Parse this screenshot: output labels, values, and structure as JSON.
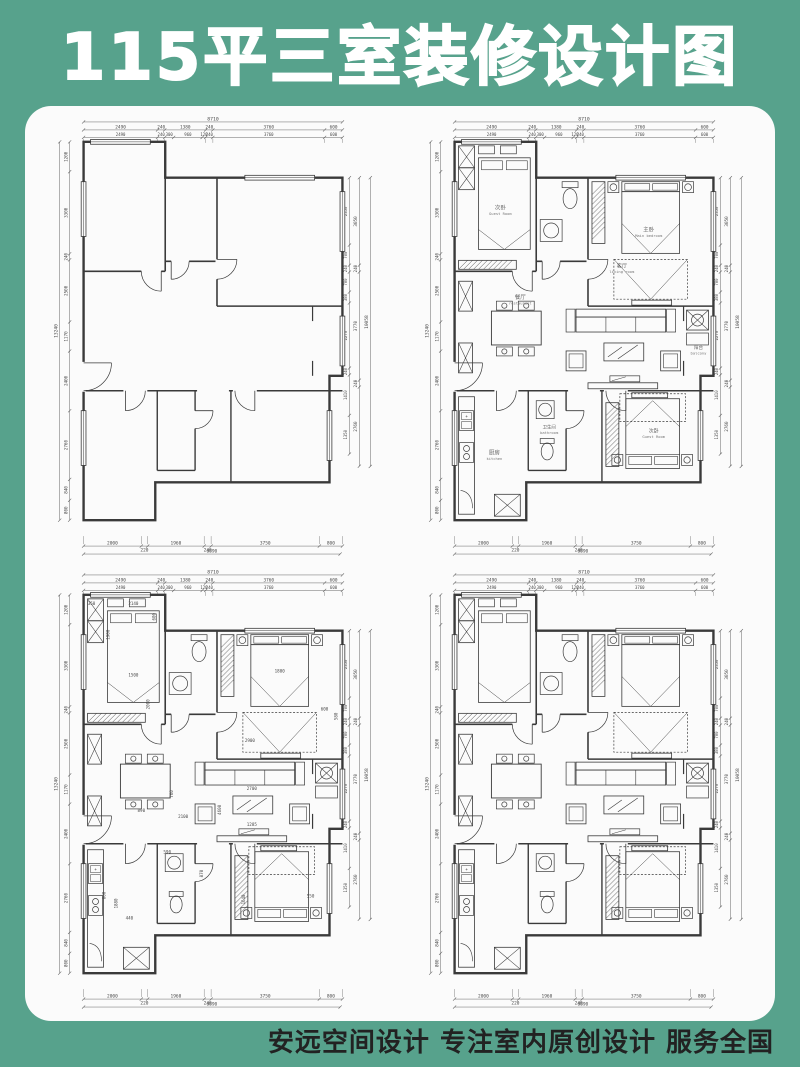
{
  "title": "115平三室装修设计图",
  "footer": "安远空间设计 专注室内原创设计 服务全国",
  "colors": {
    "background": "#57a28c",
    "panel": "#fbfbfb",
    "wall_line": "#3a3a3a",
    "dim_line": "#666666",
    "dim_text": "#4a4a4a"
  },
  "plans": [
    {
      "name": "original-structure-plan",
      "furnished": false,
      "labels": false,
      "interior_dims": false
    },
    {
      "name": "furnished-plan-labeled",
      "furnished": true,
      "labels": true,
      "interior_dims": false
    },
    {
      "name": "furnished-plan-dimensioned",
      "furnished": true,
      "labels": false,
      "interior_dims": true
    },
    {
      "name": "furnished-plan-plain",
      "furnished": true,
      "labels": false,
      "interior_dims": false
    }
  ],
  "rooms": {
    "guest1": {
      "zh": "次卧",
      "en": "Guest Room"
    },
    "main": {
      "zh": "主卧",
      "en": "Main bedroom"
    },
    "dining": {
      "zh": "餐厅",
      "en": "restaurant"
    },
    "living": {
      "zh": "客厅",
      "en": "living room"
    },
    "balcony": {
      "zh": "阳台",
      "en": "balcony"
    },
    "kitchen": {
      "zh": "厨房",
      "en": "kitchen"
    },
    "bath": {
      "zh": "卫生间",
      "en": "bathroom"
    },
    "guest2": {
      "zh": "次卧",
      "en": "Guest Room"
    }
  },
  "dimensions": {
    "top_overall": "8710",
    "top_row1": [
      "2490",
      "240",
      "1380",
      "240",
      "3760",
      "600"
    ],
    "top_row2": [
      "2490",
      "240",
      "300",
      "960",
      "120",
      "240",
      "3760",
      "600"
    ],
    "bottom_row": [
      "2000",
      "220",
      "1960",
      "240",
      "3750",
      "800"
    ],
    "bottom_overall": "8890",
    "left_col": [
      "1200",
      "3300",
      "240",
      "2500",
      "1170",
      "2400",
      "2760",
      "840",
      "800"
    ],
    "left_overall": "13240",
    "right_inner": [
      "2350",
      "700",
      "240",
      "700",
      "380",
      "2270",
      "240",
      "1410",
      "1350"
    ],
    "right_mid": [
      "3050",
      "240",
      "3770",
      "240",
      "2760"
    ],
    "right_overall": "10058"
  },
  "interior_dims": [
    "350",
    "2140",
    "1900",
    "600",
    "1500",
    "2000",
    "1800",
    "890",
    "2100",
    "760",
    "2900",
    "2700",
    "1285",
    "600",
    "580",
    "800",
    "1880",
    "440",
    "590",
    "870",
    "1640",
    "550",
    "4600"
  ]
}
